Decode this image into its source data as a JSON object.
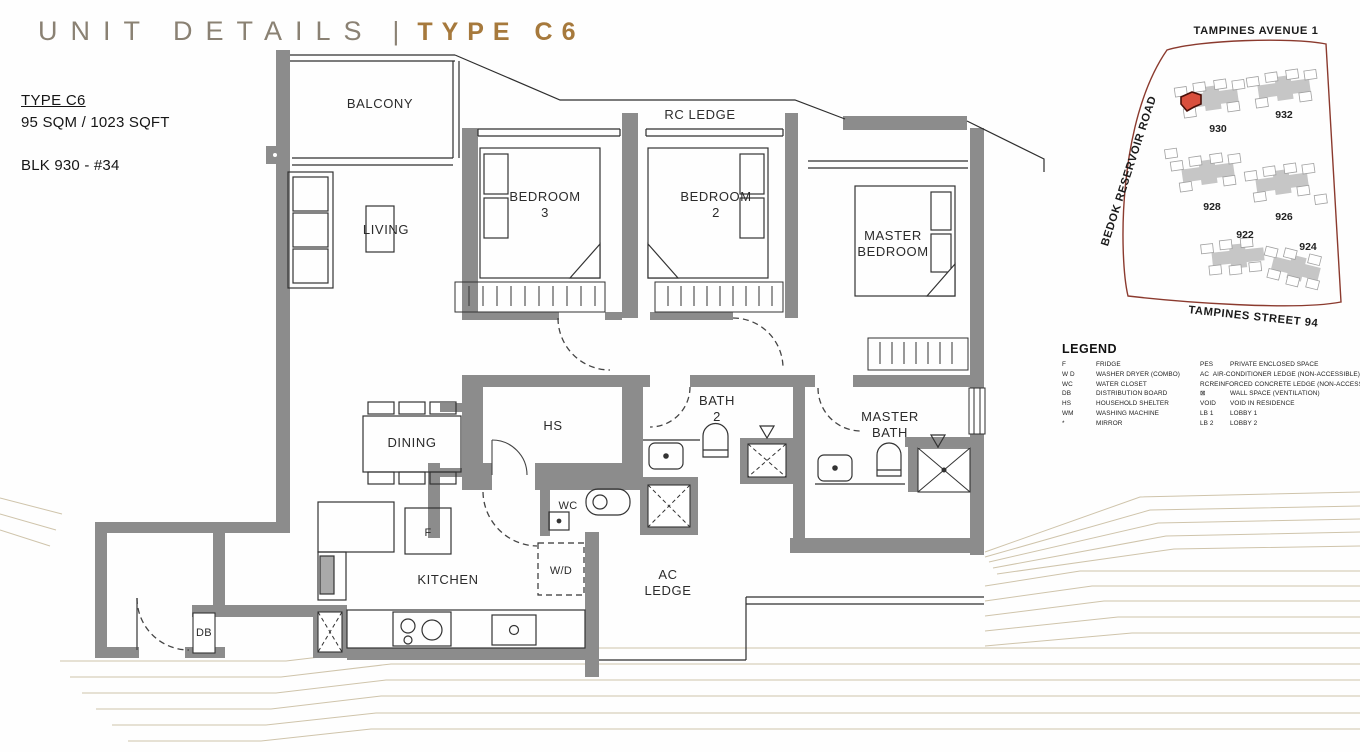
{
  "title": {
    "left": "UNIT DETAILS",
    "separator": "|",
    "right": "TYPE C6"
  },
  "unit_info": {
    "type": "TYPE C6",
    "area": "95 SQM / 1023 SQFT",
    "block": "BLK 930 - #34"
  },
  "floorplan": {
    "labels": {
      "balcony": "BALCONY",
      "rc_ledge": "RC LEDGE",
      "bedroom3_line1": "BEDROOM",
      "bedroom3_line2": "3",
      "bedroom2_line1": "BEDROOM",
      "bedroom2_line2": "2",
      "master_bedroom_line1": "MASTER",
      "master_bedroom_line2": "BEDROOM",
      "living": "LIVING",
      "dining": "DINING",
      "hs": "HS",
      "bath2_line1": "BATH",
      "bath2_line2": "2",
      "master_bath_line1": "MASTER",
      "master_bath_line2": "BATH",
      "wc": "WC",
      "fridge": "F",
      "washer_dryer": "W/D",
      "kitchen": "KITCHEN",
      "ac_ledge_line1": "AC",
      "ac_ledge_line2": "LEDGE",
      "db": "DB"
    }
  },
  "site_map": {
    "road_top": "TAMPINES AVENUE 1",
    "road_left": "BEDOK RESERVOIR ROAD",
    "road_bottom": "TAMPINES STREET 94",
    "blocks": [
      "930",
      "932",
      "928",
      "926",
      "922",
      "924"
    ]
  },
  "legend": {
    "heading": "LEGEND",
    "left": [
      {
        "key": "F",
        "value": "FRIDGE"
      },
      {
        "key": "W D",
        "value": "WASHER DRYER (COMBO)"
      },
      {
        "key": "WC",
        "value": "WATER CLOSET"
      },
      {
        "key": "DB",
        "value": "DISTRIBUTION BOARD"
      },
      {
        "key": "HS",
        "value": "HOUSEHOLD SHELTER"
      },
      {
        "key": "WM",
        "value": "WASHING MACHINE"
      },
      {
        "key": "*",
        "value": "MIRROR"
      }
    ],
    "right": [
      {
        "key": "PES",
        "value": "PRIVATE ENCLOSED SPACE"
      },
      {
        "key": "AC",
        "value": "AIR-CONDITIONER LEDGE (NON-ACCESSIBLE)"
      },
      {
        "key": "RC",
        "value": "REINFORCED CONCRETE LEDGE (NON-ACCESSIBLE)"
      },
      {
        "key": "⊠",
        "value": "WALL SPACE (VENTILATION)"
      },
      {
        "key": "VOID",
        "value": "VOID IN RESIDENCE"
      },
      {
        "key": "LB 1",
        "value": "LOBBY 1"
      },
      {
        "key": "LB 2",
        "value": "LOBBY 2"
      }
    ]
  },
  "colors": {
    "wall": "#8c8c8c",
    "line": "#2e2e2e",
    "accent": "#a6793c",
    "title_muted": "#8a8173",
    "map_boundary": "#8b3a2e",
    "unit_highlight": "#d94f3d",
    "contour": "#cfc4ab"
  }
}
